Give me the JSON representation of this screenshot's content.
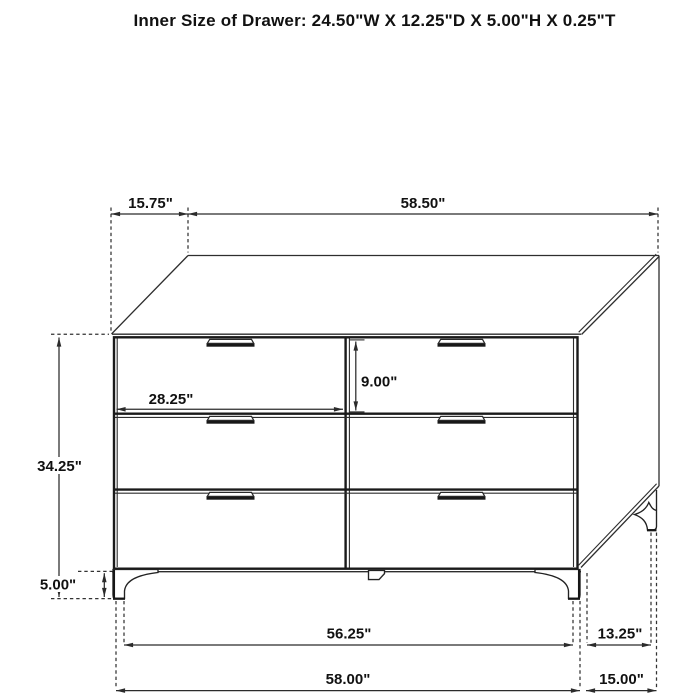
{
  "title": "Inner Size of Drawer: 24.50\"W X 12.25\"D X 5.00\"H X 0.25\"T",
  "diagram": {
    "subject": "6-drawer dresser dimensional line drawing",
    "drawer_count": 6,
    "line_color": "#2e2e2e",
    "background": "#ffffff"
  },
  "dims": {
    "top_depth": "15.75\"",
    "top_width": "58.50\"",
    "overall_height": "34.25\"",
    "drawer_width": "28.25\"",
    "drawer_height": "9.00\"",
    "leg_height": "5.00\"",
    "front_leg_span": "56.25\"",
    "side_leg_span": "13.25\"",
    "overall_width": "58.00\"",
    "overall_depth": "15.00\""
  }
}
